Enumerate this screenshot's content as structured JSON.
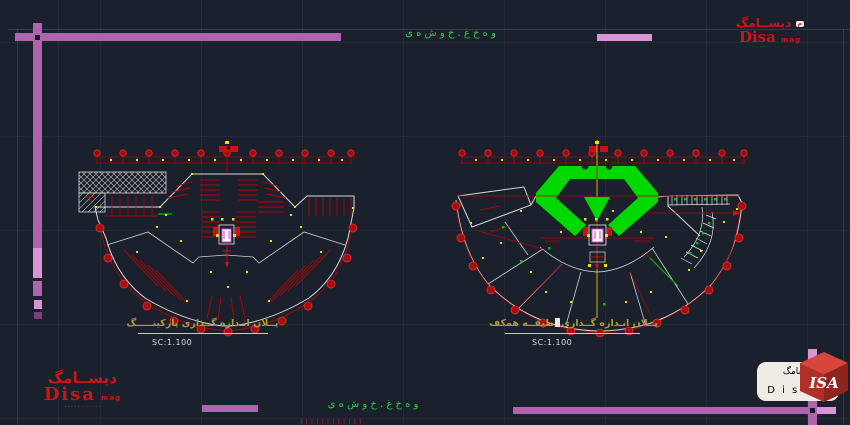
{
  "colors": {
    "bg": "#1a212c",
    "grid": "#28303d",
    "purple": "#b164ae",
    "purple-light": "#d894d4",
    "purple-dark": "#7a4080",
    "red": "#bb0000",
    "red-bright": "#e03030",
    "yellow": "#f0e000",
    "green": "#00d800",
    "green-text": "#2ecc40",
    "white-line": "#d8d8d8",
    "caption": "#ad9b3a",
    "scale-text": "#d8d8d8",
    "logo-red": "#cc1518",
    "badge-bg": "#efece6"
  },
  "header": {
    "green_text": "و ه خ غ . خ و ش ه ی"
  },
  "footer": {
    "green_text": "و ه خ غ . خ و ش ه ی",
    "red_marks": "ا ا ا ا ا ا ا ا ا ا ا ا"
  },
  "plans": {
    "left": {
      "caption": "پــلان انـدازه گــذاری پارکینـــــگ",
      "scale": "SC:1.100"
    },
    "right": {
      "caption_start": "پــلان انـدازه گــذاری",
      "caption_end": "طبقــه همکف",
      "scale": "SC:1.100"
    }
  },
  "logos": {
    "top_right": {
      "calligraphy": "ديســامگ",
      "name": "Disa",
      "suffix": "mag",
      "tagline_a": "٠٠ ٠٠٠ ٠",
      "tagline_b": "٠٠٠ ٠٠"
    },
    "bottom_left": {
      "calligraphy": "ديســامگ",
      "name": "Disa",
      "suffix": "mag",
      "tagline_a": "٠٠٠٠٠٠",
      "tagline_b": "٠٠٠٠٠"
    },
    "bottom_right": {
      "calligraphy": "ديسامگ",
      "name": "D i s a",
      "suffix": "mag",
      "cube": "ISA"
    }
  }
}
